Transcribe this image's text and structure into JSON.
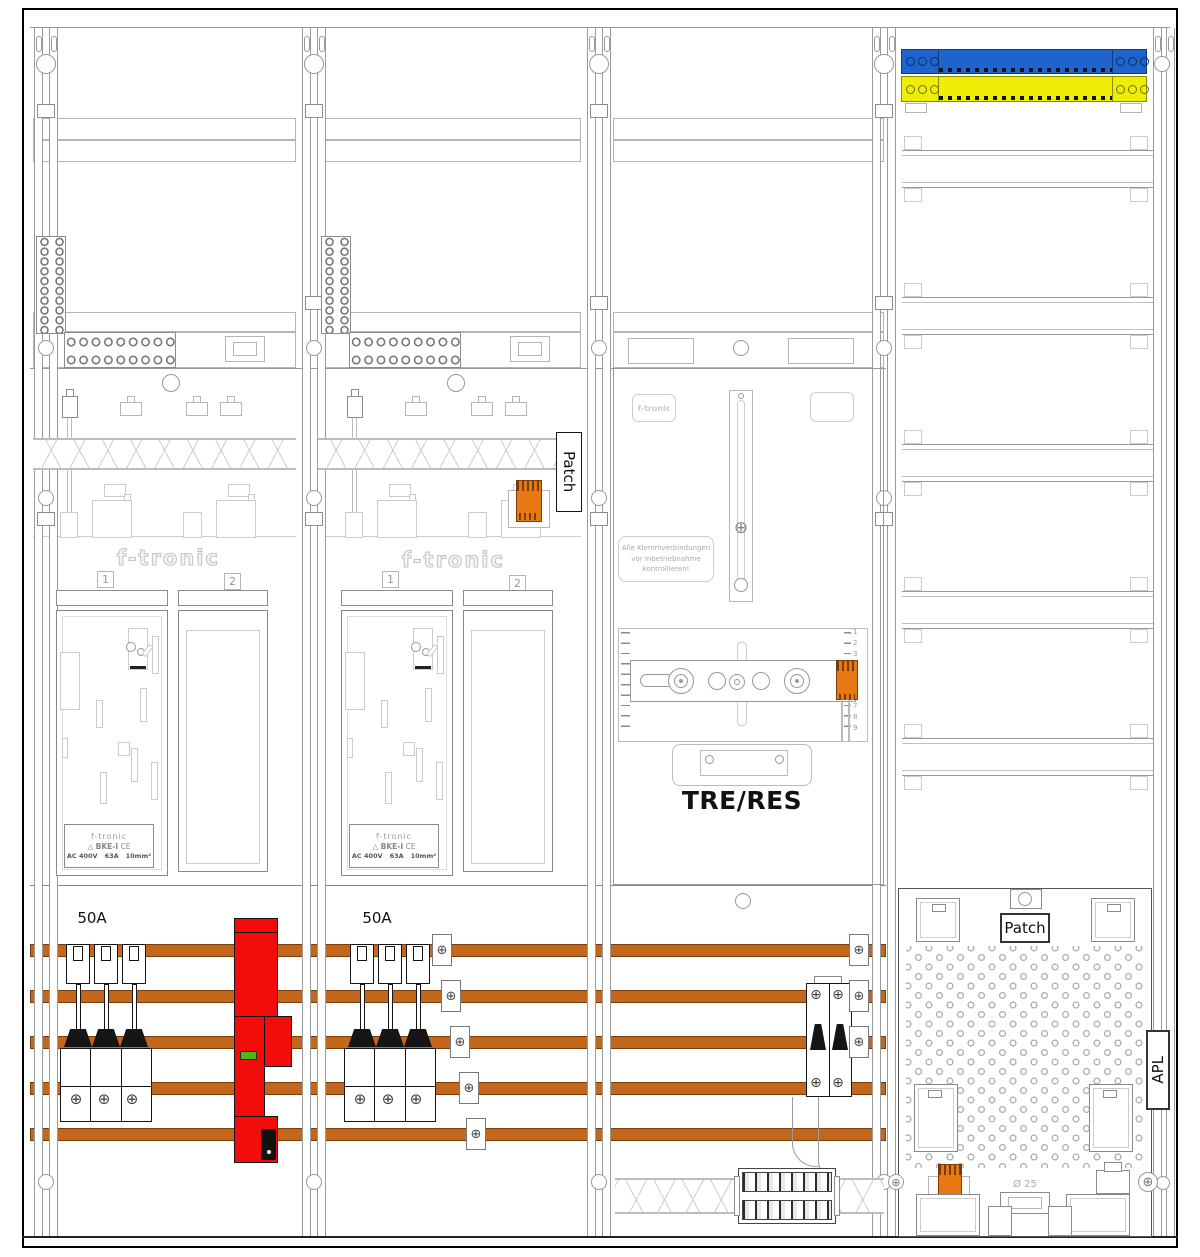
{
  "colors": {
    "busbar_copper": "#C2671B",
    "sls_red": "#F20C0C",
    "connector_orange": "#E87811",
    "neutral_blue": "#1E63CE",
    "pe_yellow": "#EDED06",
    "led_green": "#4CB81C"
  },
  "icons": {
    "screw": "⊕"
  },
  "patch_vertical_label": "Patch",
  "field1": {
    "brand_logo": "f-tronic",
    "meter_pos_1": "1",
    "meter_pos_2": "2",
    "fuse_rating": "50A",
    "bke": {
      "brand": "f-tronic",
      "symbol": "△",
      "model": "BKE-I",
      "ce": "CE",
      "voltage": "AC 400V",
      "current": "63A",
      "wire": "10mm²"
    }
  },
  "field2": {
    "brand_logo": "f-tronic",
    "meter_pos_1": "1",
    "meter_pos_2": "2",
    "fuse_rating": "50A",
    "bke": {
      "brand": "f-tronic",
      "model": "BKE-I",
      "symbol": "△",
      "ce": "CE",
      "voltage": "AC 400V",
      "current": "63A",
      "wire": "10mm²"
    }
  },
  "field3": {
    "brand_badge": "f-tronic",
    "warning": {
      "line1": "Alle Klemmverbindungen",
      "line2": "vor Inbetriebnahme",
      "line3": "kontrollieren!"
    },
    "tre_label": "TRE/RES",
    "scale_top": [
      "1",
      "2",
      "3"
    ],
    "scale_bottom": [
      "7",
      "8",
      "9"
    ]
  },
  "field4": {
    "patch_label": "Patch",
    "apl_label": "APL",
    "knockout_diameter": "Ø 25"
  }
}
